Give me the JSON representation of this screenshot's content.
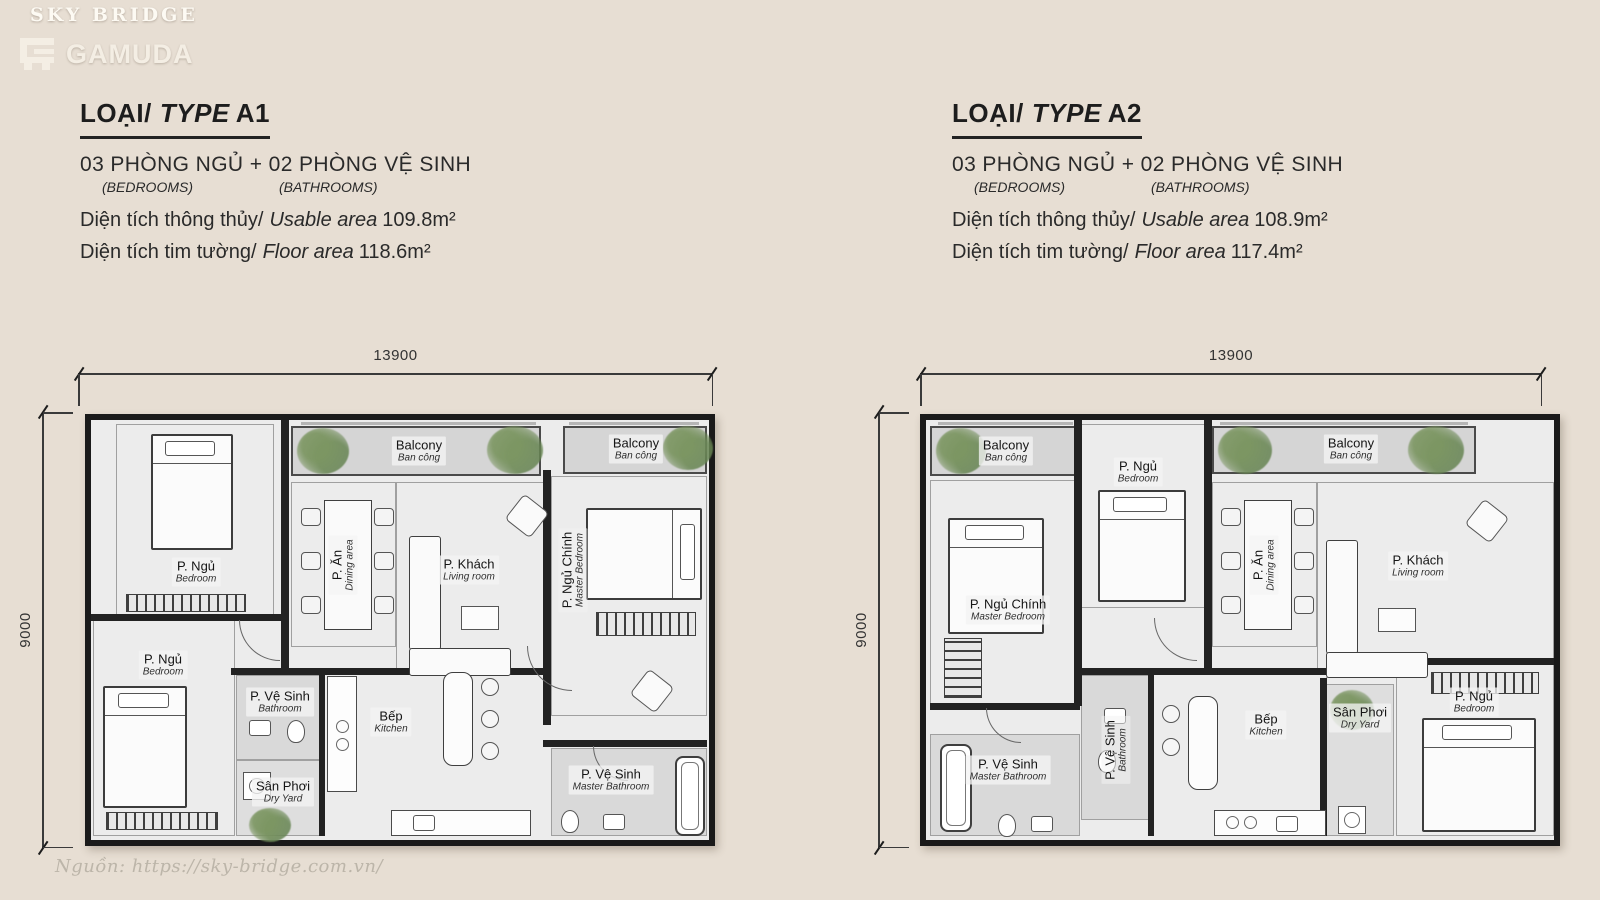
{
  "page": {
    "background_color": "#e7ded3",
    "wall_color": "#1a1a1a",
    "floor_color": "#ececec",
    "balcony_color": "#d5d5d5",
    "source_note": "Nguồn: https://sky-bridge.com.vn/"
  },
  "brand": {
    "project_name": "SKY BRIDGE",
    "developer_name": "GAMUDA",
    "logo_icon": "gamuda-monogram-icon"
  },
  "units": [
    {
      "type_prefix": "LOẠI/",
      "type_word": "TYPE",
      "type_code": "A1",
      "config_line": "03 PHÒNG NGỦ + 02 PHÒNG VỆ SINH",
      "sub_bedrooms": "(BEDROOMS)",
      "sub_bathrooms": "(BATHROOMS)",
      "usable_label_vi": "Diện tích thông thủy/",
      "usable_label_en": "Usable area",
      "usable_value": "109.8m²",
      "floor_label_vi": "Diện tích tim tường/",
      "floor_label_en": "Floor area",
      "floor_value": "118.6m²",
      "dim_width": "13900",
      "dim_height": "9000",
      "rooms": [
        {
          "vi": "P. Ngủ",
          "en": "Bedroom"
        },
        {
          "vi": "Balcony",
          "en": "Ban công"
        },
        {
          "vi": "Balcony",
          "en": "Ban công"
        },
        {
          "vi": "P. Ăn",
          "en": "Dining area"
        },
        {
          "vi": "P. Khách",
          "en": "Living room"
        },
        {
          "vi": "P. Ngủ Chính",
          "en": "Master Bedroom"
        },
        {
          "vi": "P. Ngủ",
          "en": "Bedroom"
        },
        {
          "vi": "P. Vệ Sinh",
          "en": "Bathroom"
        },
        {
          "vi": "Sân Phơi",
          "en": "Dry Yard"
        },
        {
          "vi": "Bếp",
          "en": "Kitchen"
        },
        {
          "vi": "P. Vệ Sinh",
          "en": "Master Bathroom"
        }
      ]
    },
    {
      "type_prefix": "LOẠI/",
      "type_word": "TYPE",
      "type_code": "A2",
      "config_line": "03 PHÒNG NGỦ + 02 PHÒNG VỆ SINH",
      "sub_bedrooms": "(BEDROOMS)",
      "sub_bathrooms": "(BATHROOMS)",
      "usable_label_vi": "Diện tích thông thủy/",
      "usable_label_en": "Usable area",
      "usable_value": "108.9m²",
      "floor_label_vi": "Diện tích tim tường/",
      "floor_label_en": "Floor area",
      "floor_value": "117.4m²",
      "dim_width": "13900",
      "dim_height": "9000",
      "rooms": [
        {
          "vi": "Balcony",
          "en": "Ban công"
        },
        {
          "vi": "P. Ngủ",
          "en": "Bedroom"
        },
        {
          "vi": "Balcony",
          "en": "Ban công"
        },
        {
          "vi": "P. Ngủ Chính",
          "en": "Master Bedroom"
        },
        {
          "vi": "P. Ăn",
          "en": "Dining area"
        },
        {
          "vi": "P. Khách",
          "en": "Living room"
        },
        {
          "vi": "P. Vệ Sinh",
          "en": "Master Bathroom"
        },
        {
          "vi": "P. Vệ Sinh",
          "en": "Bathroom"
        },
        {
          "vi": "Bếp",
          "en": "Kitchen"
        },
        {
          "vi": "Sân Phơi",
          "en": "Dry Yard"
        },
        {
          "vi": "P. Ngủ",
          "en": "Bedroom"
        }
      ]
    }
  ]
}
